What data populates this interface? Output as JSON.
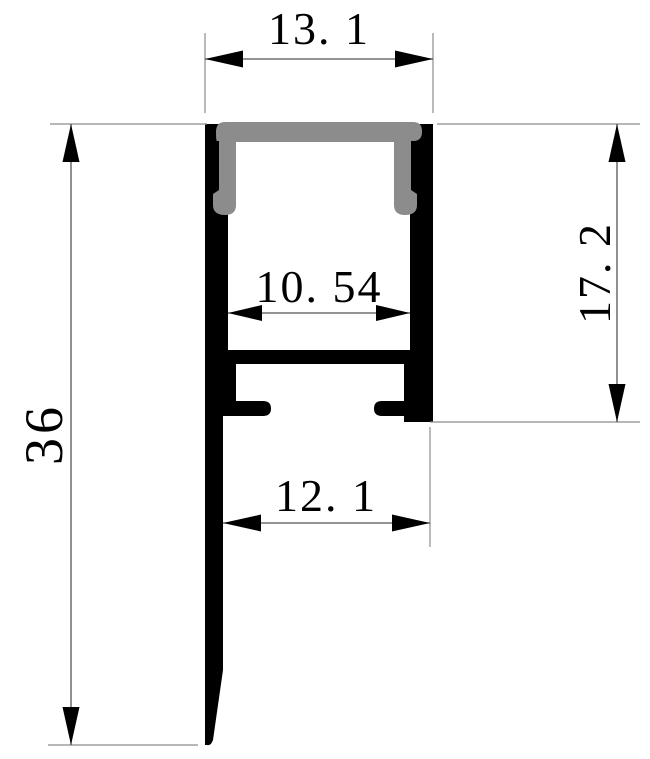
{
  "drawing": {
    "background": "#ffffff",
    "colors": {
      "profile_fill": "#000000",
      "cover_fill": "#8c8c8c",
      "dimension_line": "#555555",
      "extension_line": "#8c8c8c",
      "arrow_fill": "#000000",
      "text_color": "#000000"
    },
    "dimensions": {
      "top_width": {
        "label": "13. 1",
        "value": 13.1
      },
      "inner_width": {
        "label": "10. 54",
        "value": 10.54
      },
      "right_height": {
        "label": "17. 2",
        "value": 17.2
      },
      "total_height": {
        "label": "36",
        "value": 36
      },
      "bottom_width": {
        "label": "12. 1",
        "value": 12.1
      }
    }
  }
}
